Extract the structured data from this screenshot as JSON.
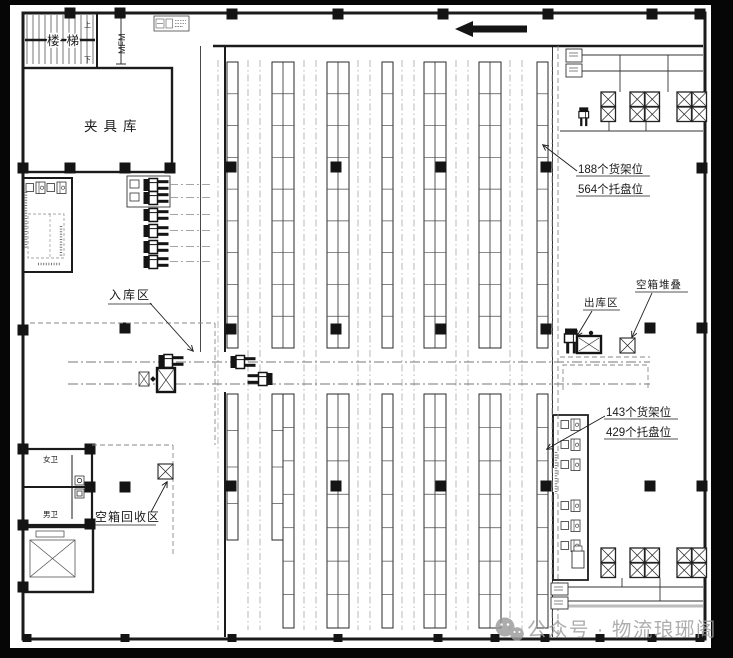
{
  "frame": {
    "paper_color": "#ffffff",
    "border_color": "#060606",
    "ink_color": "#1b1b1b",
    "guide_color": "#8e8e8e",
    "watermark_color": "#9c9c9c"
  },
  "labels": {
    "stairs": "楼梯",
    "up": "上",
    "down": "下",
    "grid_mark": "MFM",
    "fixture_warehouse": "夹具库",
    "inbound_zone": "入库区",
    "outbound_zone": "出库区",
    "empty_box_stacking": "空箱堆叠",
    "empty_box_recycling": "空箱回收区",
    "toilet_female": "女卫",
    "toilet_male": "男卫"
  },
  "annotations": {
    "north_rack_line1": "188个货架位",
    "north_rack_line2": "564个托盘位",
    "south_rack_line1": "143个货架位",
    "south_rack_line2": "429个托盘位"
  },
  "watermark": {
    "icon": "wechat-icon",
    "text": "公众号 · 物流琅琊阁"
  }
}
